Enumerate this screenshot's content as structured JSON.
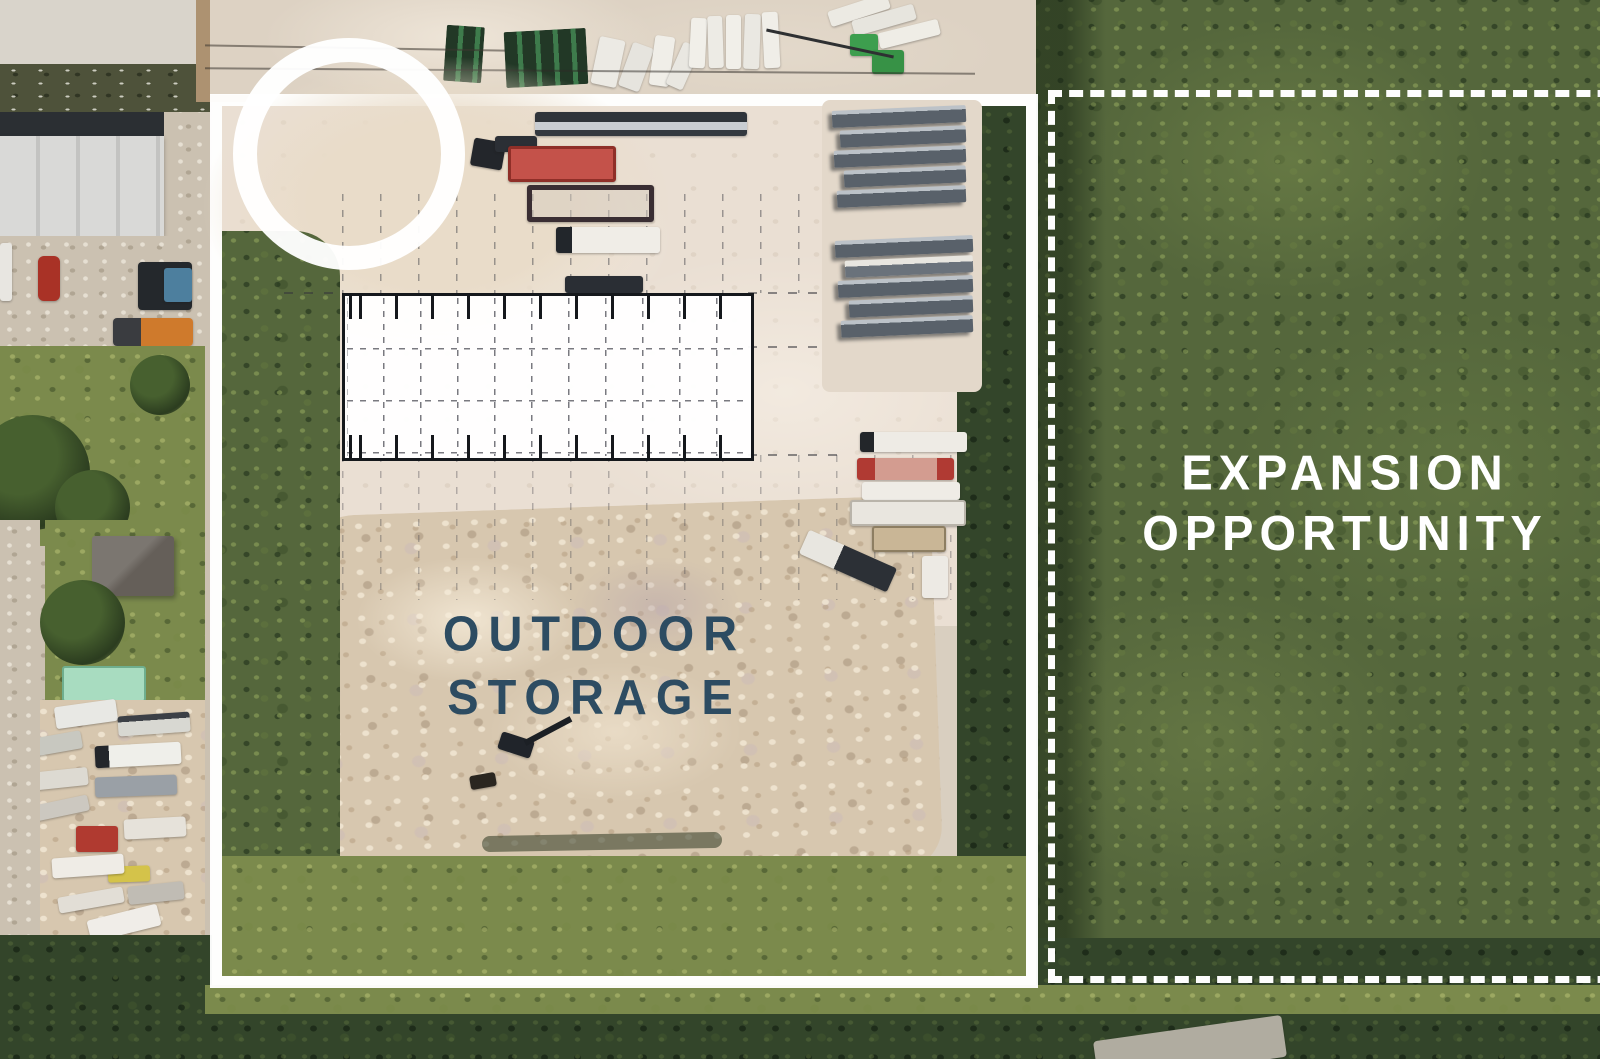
{
  "scene": {
    "type": "aerial-site-plan",
    "description": "Aerial photo of an industrial outdoor storage yard with a proposed building footprint overlay, bounded in white, next to a vegetated expansion parcel bounded by a dashed line"
  },
  "labels": {
    "outdoor_storage": {
      "line1": "OUTDOOR",
      "line2": "STORAGE",
      "color": "#2d4c62"
    },
    "expansion": {
      "line1": "EXPANSION",
      "line2": "OPPORTUNITY",
      "color": "#ffffff"
    }
  },
  "boundaries": {
    "main_property": {
      "border_style": "solid",
      "border_color": "#ffffff"
    },
    "expansion_parcel": {
      "border_style": "dashed",
      "border_color": "#ffffff"
    }
  },
  "building_footprint": {
    "fill": "#ffffff",
    "outline_color": "#15181c"
  }
}
